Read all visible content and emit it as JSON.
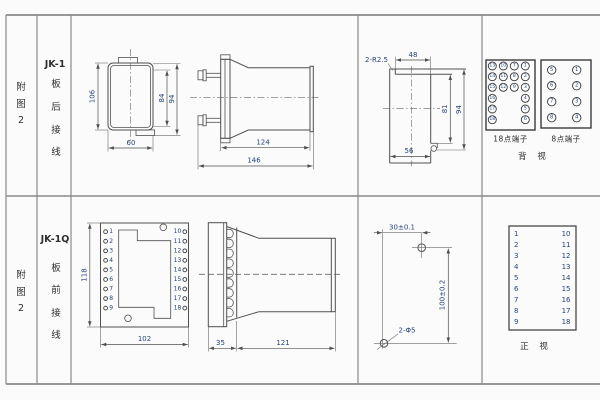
{
  "figure": {
    "top": {
      "fig_label": [
        "附",
        "图",
        "2"
      ],
      "model": "JK-1",
      "wiring": [
        "板",
        "后",
        "接",
        "线"
      ],
      "rear_view": {
        "dim_height": "106",
        "dim_inner": "84",
        "dim_outer": "94",
        "dim_width": "60"
      },
      "side_view": {
        "dim_body": "124",
        "dim_total": "146"
      },
      "cutout": {
        "note_radius": "2-R2.5",
        "dim_top": "48",
        "dim_inner": "81",
        "dim_outer": "94",
        "dim_bottom": "56"
      },
      "terminals18": {
        "label": "18点端子",
        "columns": [
          [
            13,
            14,
            15,
            16,
            17,
            18
          ],
          [
            10,
            11,
            12
          ],
          [
            7,
            8,
            9
          ],
          [
            1,
            2,
            3,
            4,
            5,
            6
          ]
        ]
      },
      "terminals8": {
        "label": "8点端子",
        "columns": [
          [
            5,
            6,
            7,
            8
          ],
          [
            1,
            2,
            3,
            4
          ]
        ]
      },
      "view_label": "背 视"
    },
    "bottom": {
      "fig_label": [
        "附",
        "图",
        "2"
      ],
      "model": "JK-1Q",
      "wiring": [
        "板",
        "前",
        "接",
        "线"
      ],
      "front_view": {
        "dim_height": "118",
        "dim_width": "102",
        "left_terminals": [
          1,
          2,
          3,
          4,
          5,
          6,
          7,
          8,
          9
        ],
        "right_terminals": [
          10,
          11,
          12,
          13,
          14,
          15,
          16,
          17,
          18
        ]
      },
      "side_view": {
        "dim_plate": "35",
        "dim_body": "121"
      },
      "drilling": {
        "dim_h": "30±0.1",
        "dim_v": "100±0.2",
        "note_holes": "2-Φ5"
      },
      "terminal_table": {
        "left": [
          1,
          2,
          3,
          4,
          5,
          6,
          7,
          8,
          9
        ],
        "right": [
          10,
          11,
          12,
          13,
          14,
          15,
          16,
          17,
          18
        ],
        "view_label": "正 视"
      }
    }
  },
  "colors": {
    "line": "#4f4f4f",
    "dim_text": "#25437a",
    "border": "#8a8a8a",
    "background": "#fbfbfb"
  }
}
